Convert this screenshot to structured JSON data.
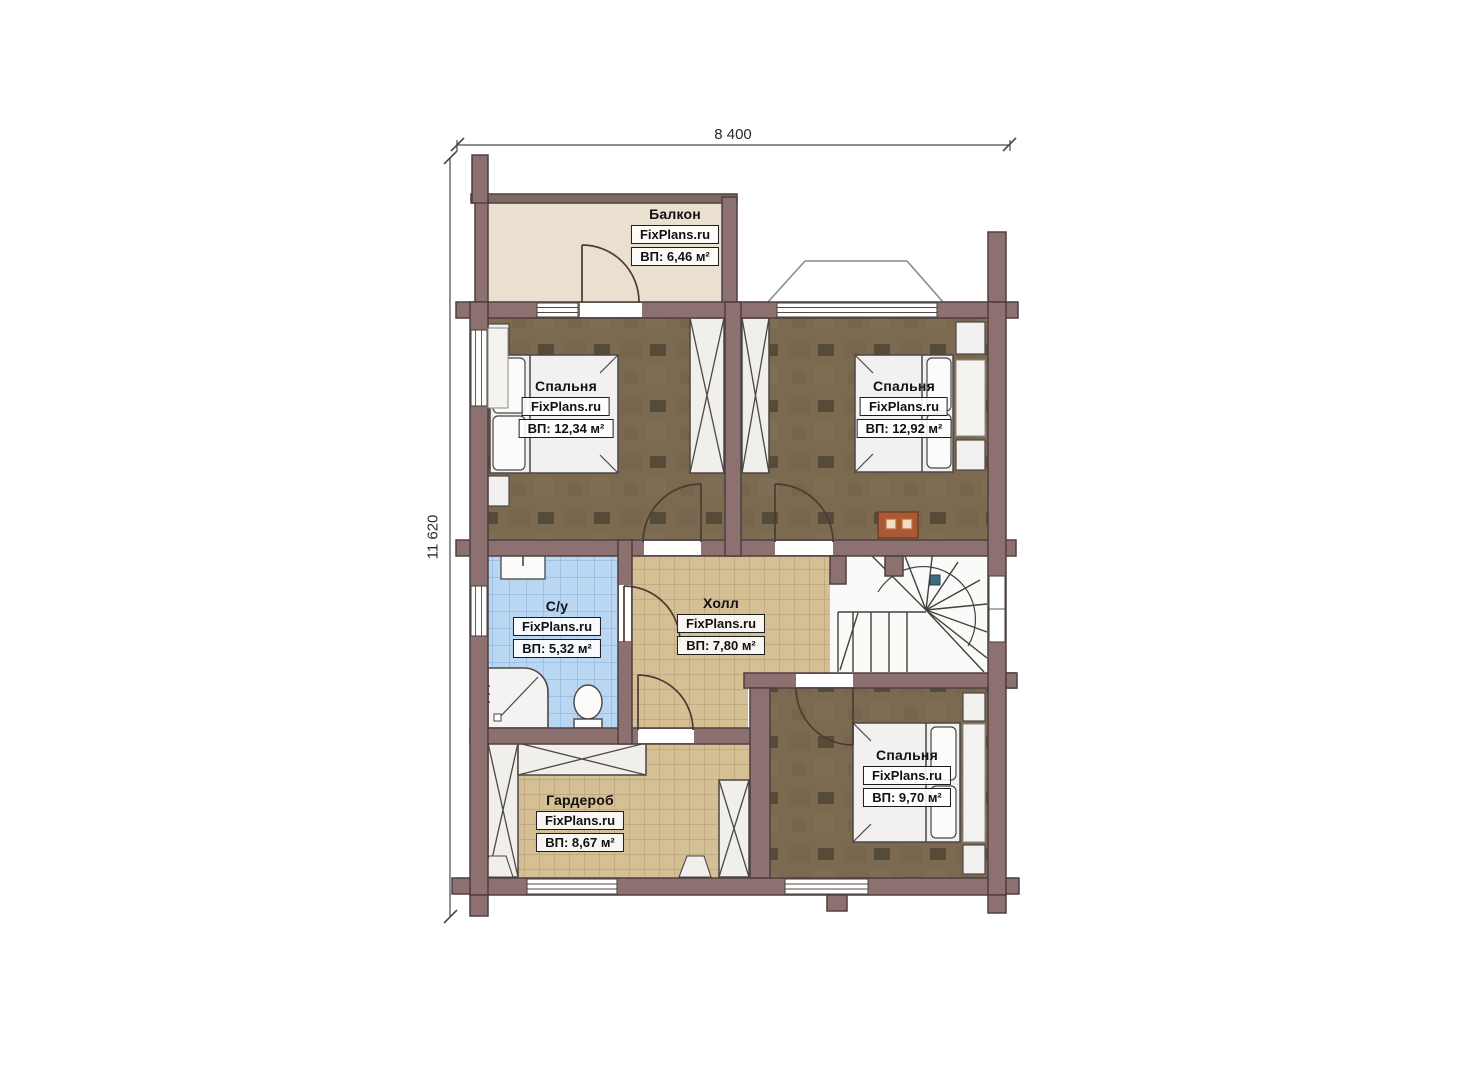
{
  "plan": {
    "type": "floor-plan-second-storey",
    "dimensions": {
      "width_label": "8 400",
      "height_label": "11 620"
    },
    "brand": "FixPlans.ru",
    "rooms": [
      {
        "id": "balcony",
        "name": "Балкон",
        "brand": "FixPlans.ru",
        "area": "ВП: 6,46 м²"
      },
      {
        "id": "bedroom-top-left",
        "name": "Спальня",
        "brand": "FixPlans.ru",
        "area": "ВП: 12,34 м²"
      },
      {
        "id": "bedroom-top-right",
        "name": "Спальня",
        "brand": "FixPlans.ru",
        "area": "ВП: 12,92 м²"
      },
      {
        "id": "bathroom",
        "name": "С/у",
        "brand": "FixPlans.ru",
        "area": "ВП: 5,32 м²"
      },
      {
        "id": "hall",
        "name": "Холл",
        "brand": "FixPlans.ru",
        "area": "ВП: 7,80 м²"
      },
      {
        "id": "wardrobe",
        "name": "Гардероб",
        "brand": "FixPlans.ru",
        "area": "ВП: 8,67 м²"
      },
      {
        "id": "bedroom-bottom",
        "name": "Спальня",
        "brand": "FixPlans.ru",
        "area": "ВП: 9,70 м²"
      }
    ],
    "colors": {
      "wall": "#8d7171",
      "wall_outline": "#4e3f3f",
      "bedroom_floor": "#7b6a50",
      "hall_tile": "#d5bf95",
      "bathroom_tile": "#b9d6f2",
      "balcony_floor": "#e9e0cf",
      "fireplace": "#a85a36",
      "paper": "#ffffff"
    }
  }
}
